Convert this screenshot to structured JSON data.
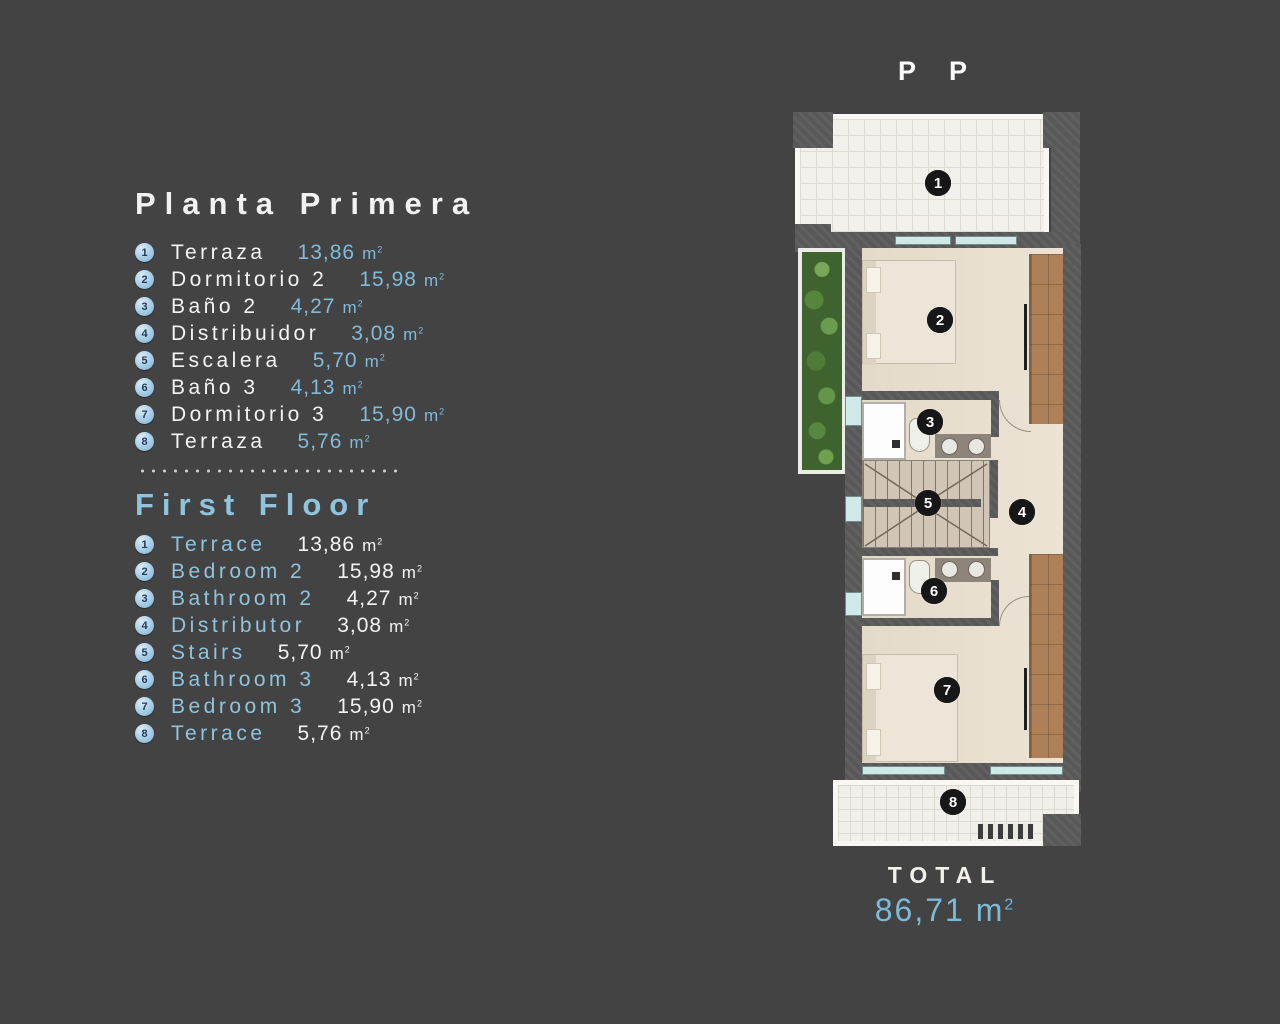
{
  "title": "P P",
  "legend": {
    "primary": {
      "heading": "Planta Primera",
      "items": [
        {
          "num": "1",
          "label": "Terraza",
          "area": "13,86"
        },
        {
          "num": "2",
          "label": "Dormitorio 2",
          "area": "15,98"
        },
        {
          "num": "3",
          "label": "Baño 2",
          "area": "4,27"
        },
        {
          "num": "4",
          "label": "Distribuidor",
          "area": "3,08"
        },
        {
          "num": "5",
          "label": "Escalera",
          "area": "5,70"
        },
        {
          "num": "6",
          "label": "Baño 3",
          "area": "4,13"
        },
        {
          "num": "7",
          "label": "Dormitorio 3",
          "area": "15,90"
        },
        {
          "num": "8",
          "label": "Terraza",
          "area": "5,76"
        }
      ]
    },
    "secondary": {
      "heading": "First Floor",
      "items": [
        {
          "num": "1",
          "label": "Terrace",
          "area": "13,86"
        },
        {
          "num": "2",
          "label": "Bedroom 2",
          "area": "15,98"
        },
        {
          "num": "3",
          "label": "Bathroom 2",
          "area": "4,27"
        },
        {
          "num": "4",
          "label": "Distributor",
          "area": "3,08"
        },
        {
          "num": "5",
          "label": "Stairs",
          "area": "5,70"
        },
        {
          "num": "6",
          "label": "Bathroom 3",
          "area": "4,13"
        },
        {
          "num": "7",
          "label": "Bedroom 3",
          "area": "15,90"
        },
        {
          "num": "8",
          "label": "Terrace",
          "area": "5,76"
        }
      ]
    }
  },
  "units": {
    "base": "m",
    "exp": "2"
  },
  "total": {
    "label": "TOTAL",
    "value": "86,71"
  },
  "floorplan": {
    "markers": [
      {
        "num": "1"
      },
      {
        "num": "2"
      },
      {
        "num": "3"
      },
      {
        "num": "4"
      },
      {
        "num": "5"
      },
      {
        "num": "6"
      },
      {
        "num": "7"
      },
      {
        "num": "8"
      }
    ]
  },
  "colors": {
    "background": "#434343",
    "accent_blue": "#8fc3de",
    "value_blue": "#7db9d9",
    "text_white": "#f2f2f2",
    "wall_gray": "#585858",
    "floor_beige": "#e8dfd1",
    "wardrobe_brown": "#ad8058",
    "marker_black": "#171717",
    "legend_circle_blue": "#a5cbe6"
  }
}
